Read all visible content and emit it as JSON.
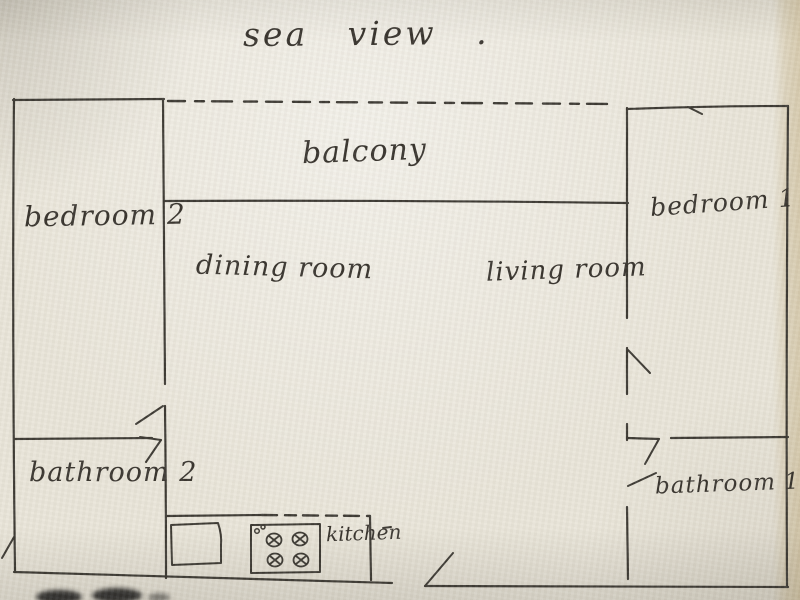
{
  "title": "sea view .",
  "rooms": {
    "balcony": "balcony",
    "bedroom2": "bedroom 2",
    "bedroom1": "bedroom 1",
    "dining": "dining room",
    "living": "living room",
    "bathroom2": "bathroom 2",
    "bathroom1": "bathroom 1",
    "kitchen": "kitchen"
  },
  "colors": {
    "ink": "#393630",
    "paper": "#e9e5d9",
    "paper_edge": "#d9cba8"
  }
}
